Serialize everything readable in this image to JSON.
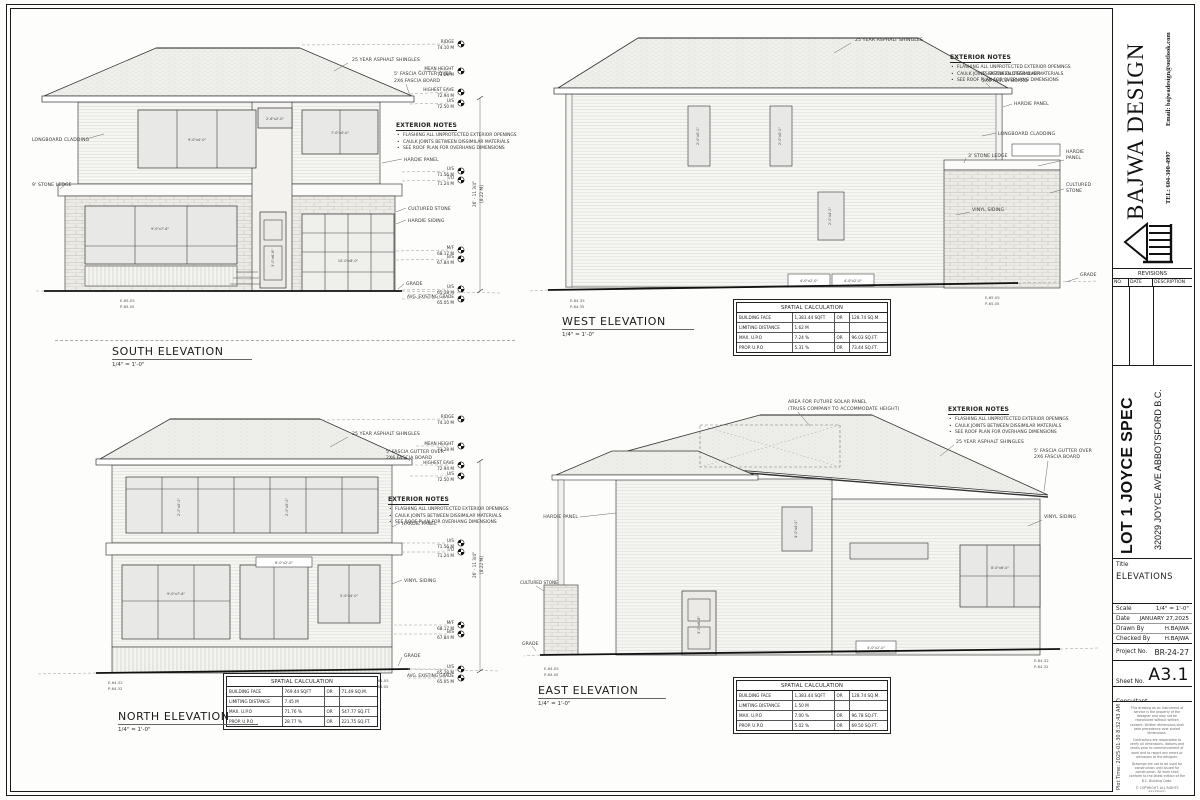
{
  "titleblock": {
    "firm_name": "BAJWA DESIGN",
    "tel": "TEL: 604-300-4997",
    "email": "Email: bajwadesign@outlook.com",
    "revisions_title": "REVISIONS",
    "rev_no": "NO.",
    "rev_date": "DATE",
    "rev_desc": "DESCRIPTION",
    "project_name": "LOT 1 JOYCE SPEC",
    "project_address": "32029 JOYCE AVE ABBOTSFORD B.C.",
    "title_label": "Title",
    "sheet_title": "ELEVATIONS",
    "scale_label": "Scale",
    "scale_value": "1/4\" = 1'-0\"",
    "date_label": "Date",
    "date_value": "JANUARY 27,2025",
    "drawn_label": "Drawn By",
    "drawn_value": "H.BAJWA",
    "checked_label": "Checked By",
    "checked_value": "H.BAJWA",
    "project_no_label": "Project No.",
    "project_no_value": "BR-24-27",
    "sheet_no_label": "Sheet No.",
    "sheet_no_value": "A3.1",
    "consultant_label": "Consultant",
    "plot_time": "Plot Time:  2025-01-30 8:32:43 AM",
    "disclaimer": [
      "This drawing as an instrument of service is the property of the designer and may not be reproduced without written consent. Written dimensions shall take precedence over scaled dimensions.",
      "Contractors are responsible to verify all dimensions, datums and levels prior to commencement of work and to report any errors or omissions to the designer.",
      "Drawings are not to be used for construction until issued for construction. All work shall conform to the latest edition of the B.C. Building Code.",
      "© COPYRIGHT. ALL RIGHTS RESERVED"
    ]
  },
  "notes": {
    "title": "EXTERIOR NOTES",
    "items": [
      "FLASHING ALL UNPROTECTED EXTERIOR OPENINGS",
      "CAULK JOINTS BETWEEN DISSIMILAR MATERIALS",
      "SEE ROOF PLAN FOR OVERHANG DIMENSIONS"
    ]
  },
  "tables": {
    "title": "SPATIAL CALCULATION",
    "west": {
      "rows": [
        [
          "BUILDING FACE",
          "1,383.44 SQFT",
          "OR",
          "128.74 SQ.M."
        ],
        [
          "LIMITING DISTANCE",
          "1.62 M",
          "",
          ""
        ],
        [
          "MAX. U.P.O",
          "7.24 %",
          "OR",
          "96.03 SQ.FT."
        ],
        [
          "PROP. U.P.O",
          "5.31 %",
          "OR",
          "73.44 SQ.FT."
        ]
      ]
    },
    "north": {
      "rows": [
        [
          "BUILDING FACE",
          "769.44 SQFT",
          "OR",
          "71.49 SQ.M."
        ],
        [
          "LIMITING DISTANCE",
          "7.45 M",
          "",
          ""
        ],
        [
          "MAX. U.P.O",
          "71.76 %",
          "OR",
          "547.77 SQ.FT."
        ],
        [
          "PROP. U.P.O",
          "28.77 %",
          "OR",
          "221.75 SQ.FT."
        ]
      ]
    },
    "east": {
      "rows": [
        [
          "BUILDING FACE",
          "1,383.44 SQFT",
          "OR",
          "128.74 SQ.M."
        ],
        [
          "LIMITING DISTANCE",
          "1.50 M",
          "",
          ""
        ],
        [
          "MAX. U.P.O",
          "7.00 %",
          "OR",
          "96.78 SQ.FT."
        ],
        [
          "PROP. U.P.O",
          "5.02 %",
          "OR",
          "69.50 SQ.FT."
        ]
      ]
    }
  },
  "elevations": {
    "south": {
      "title": "SOUTH ELEVATION",
      "scale": "1/4\" = 1'-0\""
    },
    "west": {
      "title": "WEST ELEVATION",
      "scale": "1/4\" = 1'-0\""
    },
    "north": {
      "title": "NORTH ELEVATION",
      "scale": "1/4\" = 1'-0\""
    },
    "east": {
      "title": "EAST ELEVATION",
      "scale": "1/4\" = 1'-0\""
    }
  },
  "labels": {
    "shingles": "25 YEAR ASPHALT SHINGLES",
    "fascia_1": "5' FASCIA GUTTER OVER",
    "fascia_2": "2X6 FASCIA BOARD",
    "longboard": "LONGBOARD CLADDING",
    "stone_ledge_9": "9' STONE LEDGE",
    "stone_ledge_3": "3' STONE LEDGE",
    "hardie_panel": "HARDIE PANEL",
    "hardie": "HARDIE",
    "panel": "PANEL",
    "hardie_siding": "HARDIE SIDING",
    "cultured_stone": "CULTURED STONE",
    "cultured": "CULTURED",
    "stone": "STONE",
    "vinyl_siding": "VINYL SIDING",
    "grade": "GRADE",
    "solar_1": "AREA FOR FUTURE SOLAR PANEL",
    "solar_2": "(TRUSS COMPANY TO ACCOMMODATE HEIGHT)"
  },
  "marks": {
    "ridge": "RIDGE",
    "ridge_v": "74.10 M",
    "mean": "MEAN HEIGHT",
    "mean_v": "73.28 M",
    "heave": "HIGHEST EAVE",
    "heave_v": "72.94 M",
    "us": "U/S",
    "us_v": "72.50 M",
    "us2": "U/S",
    "us2_v": "71.56 M",
    "to": "T/O",
    "to_v": "71.24 M",
    "mf": "M/F",
    "mf_v": "68.17 M",
    "bs": "B/S",
    "bs_v": "67.84 M",
    "us3": "U/S",
    "us3_v": "65.28 M",
    "avg": "AVG. EXISTING GRADE",
    "avg_v": "65.05 M"
  },
  "grades": {
    "e_sw": "E-65.05",
    "p_sw": "P-65.05",
    "e_nw": "E-64.35",
    "p_nw": "P-64.35",
    "e_ne": "E-64.32",
    "p_ne": "P-64.32",
    "e_se": "E-64.05",
    "p_se": "P-64.05"
  },
  "dims": {
    "height_ft": "26' - 11 3/4\"",
    "height_m": "[8.22 M]",
    "win_9x4": "9'-0\"x4'-0\"",
    "win_7x4": "7'-0\"x4'-0\"",
    "win_2x2": "2'-6\"x2'-0\"",
    "win_9x76": "9'-0\"x7'-6\"",
    "door_3x68": "3'-0\"x6'-8\"",
    "gar_10x8": "10'-0\"x8'-0\"",
    "win_2x5": "2'-0\"x5'-0\"",
    "win_2x4": "2'-0\"x4'-0\"",
    "win_4x2": "4'-0\"x2'-0\"",
    "win_4x4": "4'-0\"x4'-0\"",
    "win_6x2": "6'-0\"x2'-0\"",
    "win_8x6": "8'-0\"x6'-0\"",
    "win_5x4": "5'-0\"x4'-0\""
  }
}
